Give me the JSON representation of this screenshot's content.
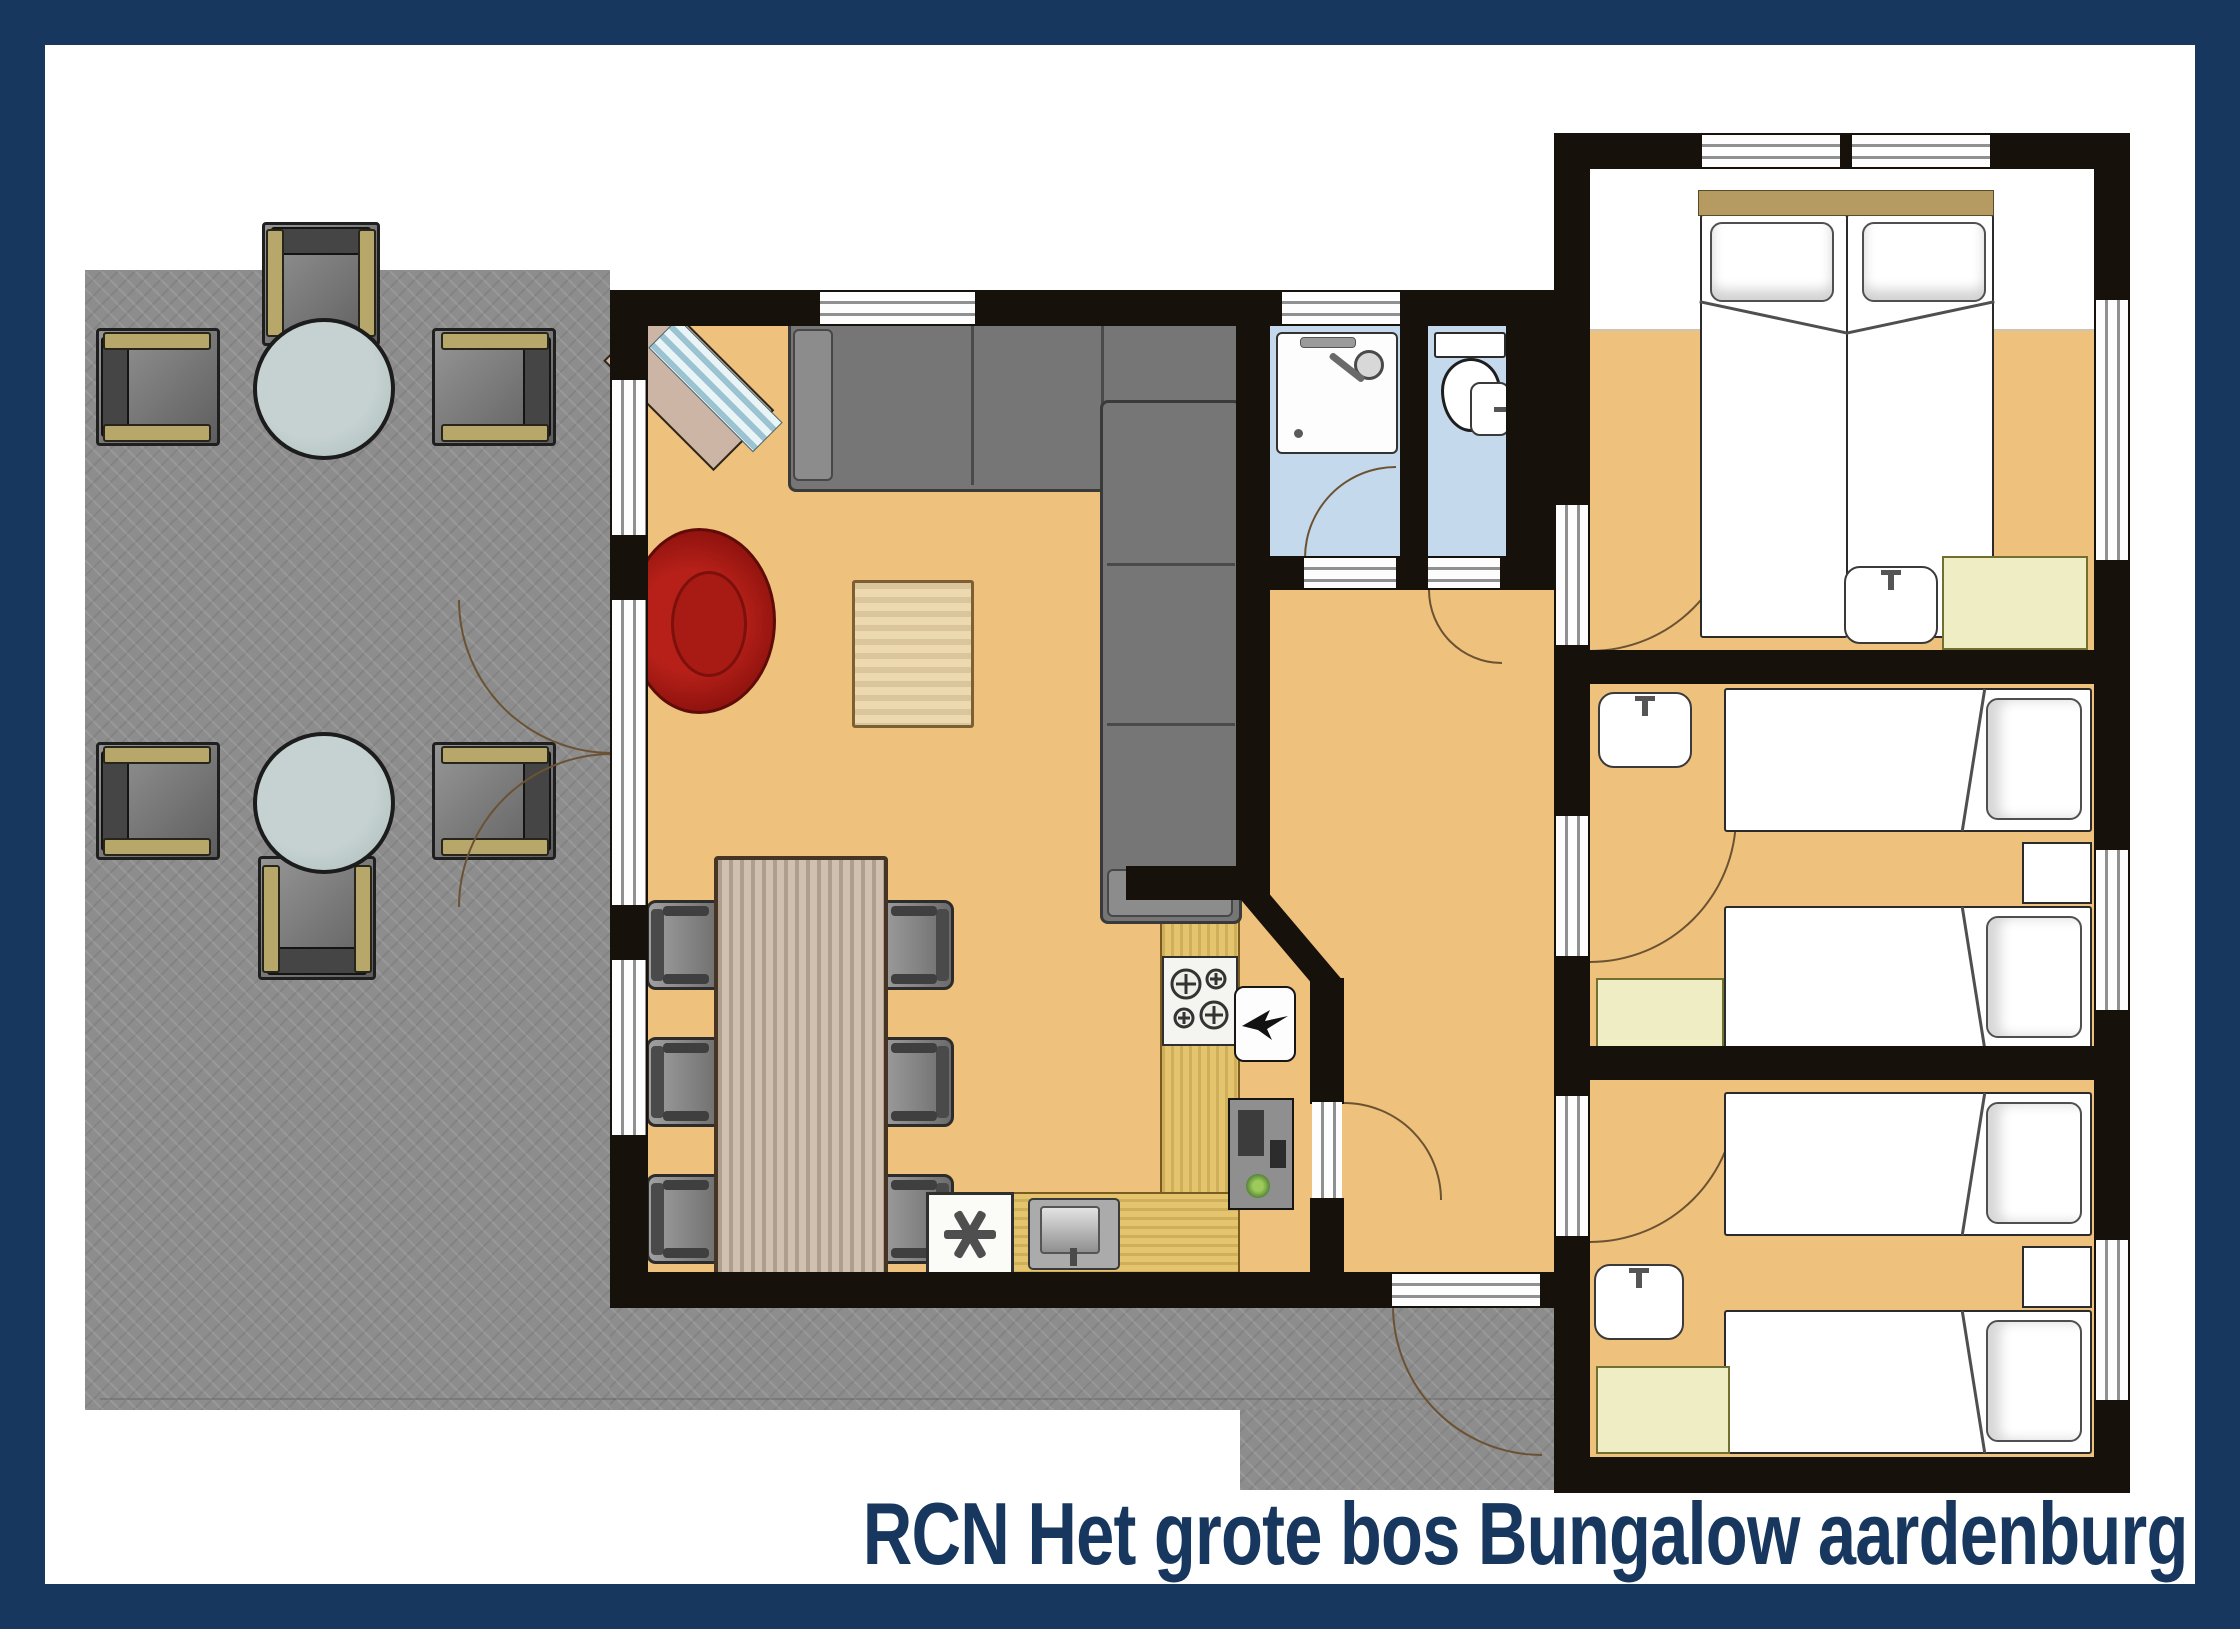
{
  "title": {
    "text": "RCN Het grote bos Bungalow aardenburg"
  },
  "colors": {
    "navy": "#17375e",
    "wall": "#17110b",
    "floor": "#eec17c",
    "patio": "#8d8d8d",
    "bath_floor": "#c4d9ec",
    "counter_wood": "#e5c46e",
    "table_wood": "#cfc0b0",
    "cabinet_yellow": "#eeedc4",
    "sofa_gray": "#767676",
    "armchair_red": "#a81b14",
    "sideboard": "#cdb5a5",
    "headboard_tan": "#b59a62",
    "glass_blue": "#9cc3d2"
  },
  "plan": {
    "type": "bungalow-floor-plan",
    "terrace": {
      "round_tables": 2,
      "patio_chairs": 6,
      "paving": "grey herringbone"
    },
    "living_room": {
      "furniture": [
        "corner-sofa",
        "red-armchair",
        "coffee-table",
        "diagonal-sideboard-with-glass",
        "dining-table",
        "dining-chairs x6"
      ],
      "windows": 3,
      "french-doors-to-terrace": 1
    },
    "kitchen": {
      "layout": "L-shaped counter",
      "appliances": [
        "stove-4-burners",
        "kitchen-sink",
        "freezer-asterisk",
        "extractor-unit",
        "cabinet-with-plant"
      ]
    },
    "bathroom": {
      "fixtures": [
        "shower-cabin"
      ],
      "floor": "light blue"
    },
    "toilet_room": {
      "fixtures": [
        "toilet",
        "hand-basin"
      ],
      "floor": "light blue"
    },
    "hallway": {
      "doors": [
        "entrance-door",
        "kitchen-door",
        "bathroom-door",
        "toilet-door",
        "bedroom-doors x3"
      ]
    },
    "bedroom_1": {
      "beds": "double (two singles joined)",
      "extras": [
        "wash-basin",
        "cabinet"
      ],
      "position": "top-right"
    },
    "bedroom_2": {
      "beds": "two singles",
      "extras": [
        "wash-basin",
        "cabinet",
        "nightstand"
      ],
      "position": "middle-right"
    },
    "bedroom_3": {
      "beds": "two singles",
      "extras": [
        "wash-basin",
        "cabinet",
        "nightstand"
      ],
      "position": "bottom-right"
    }
  }
}
